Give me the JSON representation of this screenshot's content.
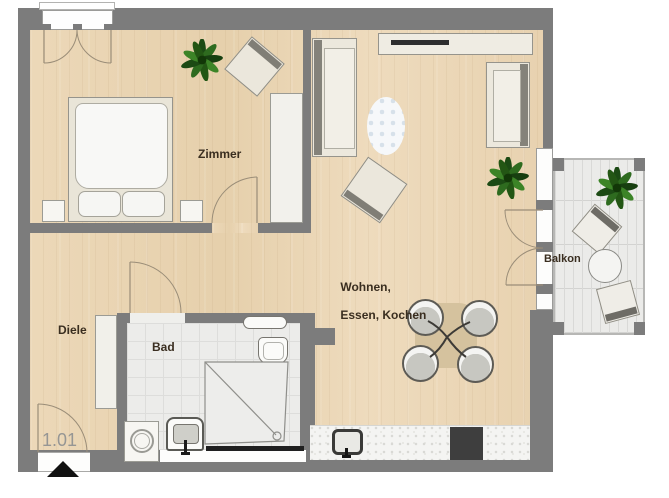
{
  "floorplan": {
    "unit": {
      "number": "1.01"
    },
    "rooms": {
      "zimmer": {
        "label": "Zimmer"
      },
      "wohnen": {
        "label_line1": "Wohnen,",
        "label_line2": "Essen, Kochen"
      },
      "diele": {
        "label": "Diele"
      },
      "bad": {
        "label": "Bad"
      },
      "balkon": {
        "label": "Balkon"
      }
    },
    "furniture_items": [
      "double-bed",
      "nightstand",
      "wardrobe",
      "plant",
      "chair",
      "sofa",
      "sideboard-tv",
      "rug",
      "armchair",
      "dining-table",
      "dining-chair",
      "kitchen-counter",
      "kitchen-sink",
      "cooktop",
      "washing-machine",
      "bathroom-sink",
      "shower",
      "toilet",
      "hall-cabinet",
      "balcony-table",
      "balcony-chair"
    ],
    "colors": {
      "wall": "#7c7c7c",
      "wood_floor": "#e9d4b3",
      "tile_floor": "#ececea",
      "balcony_floor": "#ebebe9",
      "furniture_cream": "#ece8dd",
      "accent_dark": "#3e3e3e",
      "label_text": "#3a2e20",
      "unit_text": "#969694",
      "plant_green": "#2e6b1f"
    }
  }
}
